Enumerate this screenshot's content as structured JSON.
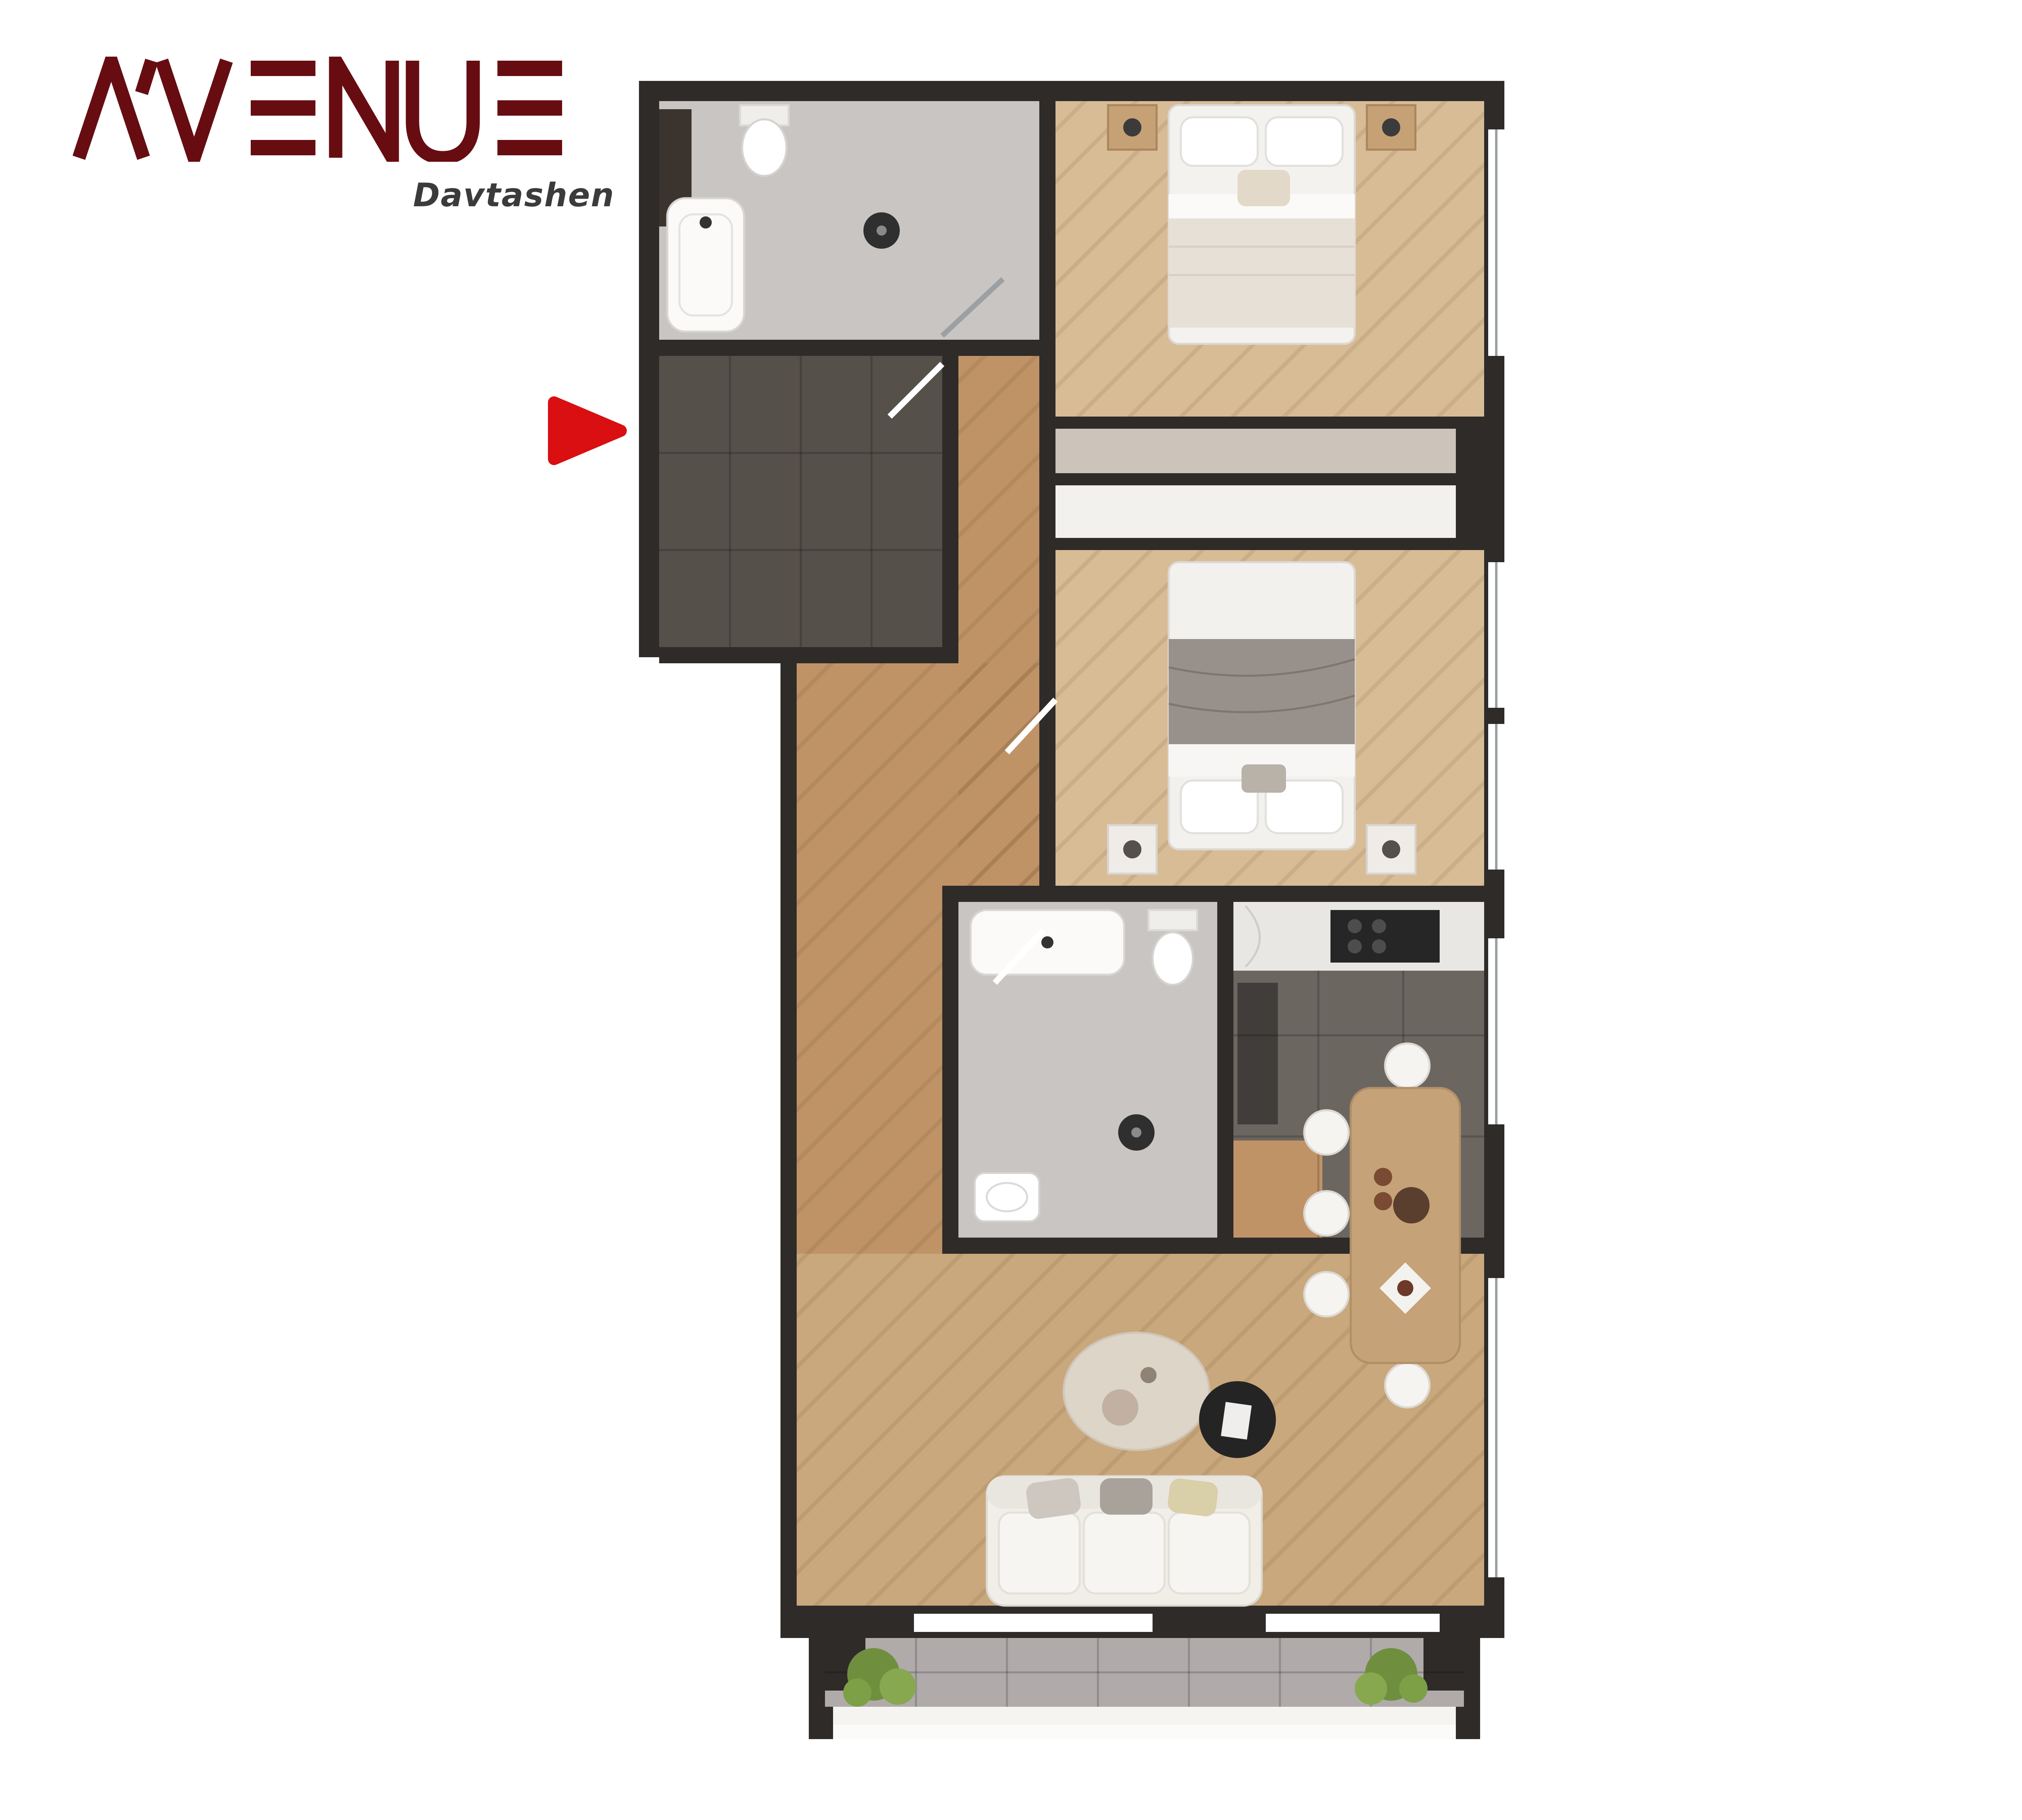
{
  "brand": {
    "name": "AVENUE",
    "sub": "Davtashen"
  },
  "unit": {
    "area_label": "91.6 մ²",
    "rooms_label": "3 սենյակ"
  },
  "room_list": [
    {
      "label": "1.Միջանցք",
      "value": "16,96մ²"
    },
    {
      "label": "2.Ընդ. սենյակ",
      "value": "17,74մ²"
    },
    {
      "label": "3.Խոհանոց",
      "value": "8,04մ²"
    },
    {
      "label": "4.Սանհանգույց 1",
      "value": "4,88մ²"
    },
    {
      "label": "5.Սանհանգույց 2",
      "value": "5,31մ²"
    },
    {
      "label": "6.Ննջասենյակ 1",
      "value": "14,47մ²"
    },
    {
      "label": "7.Ննջասենյակ 2",
      "value": "15,84մ²"
    },
    {
      "label": "8.Պատշգամբ",
      "value": "8,36մ²"
    }
  ],
  "colors": {
    "panel_green": "#8b9d62",
    "brand_maroon": "#670d12",
    "marker_red": "#d90f12",
    "highlight_brown": "#8a6d4a",
    "column_red": "#9c120f",
    "wall_dark": "#2e2b29",
    "wood_floor": "#c9a87d",
    "text_white": "#ffffff"
  },
  "icons": {
    "entry_marker": "play-triangle-icon",
    "site_plan": "building-floorplan",
    "apartment_plan": "apartment-floorplan"
  }
}
